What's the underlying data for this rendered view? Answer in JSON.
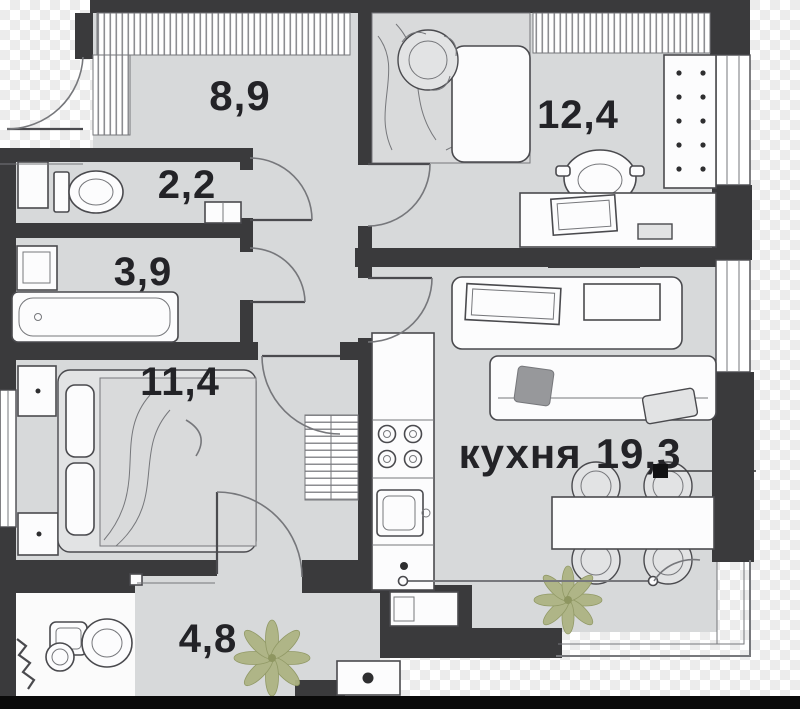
{
  "image": {
    "type": "apartment-floor-plan",
    "background": "transparency-checkerboard",
    "letterbox_bottom": true
  },
  "colors": {
    "wall": "#3a3a3c",
    "floor": "#d7d9da",
    "outline": "#4a4a4e",
    "outline2": "#76777b",
    "plant": "#adb483",
    "plantdk": "#8e9660",
    "letterbox": "#0a0a0a",
    "label_text": "#232327"
  },
  "rooms": {
    "hallway": {
      "area": "8,9",
      "furniture": [
        "wardrobe-hatch"
      ]
    },
    "wc": {
      "area": "2,2",
      "furniture": [
        "toilet",
        "shaft-box",
        "washbasin"
      ]
    },
    "bathroom": {
      "area": "3,9",
      "furniture": [
        "sink-cabinet",
        "bathtub"
      ]
    },
    "bedroom": {
      "area": "11,4",
      "furniture": [
        "double-bed",
        "nightstand",
        "nightstand",
        "wardrobe-hatch",
        "window"
      ]
    },
    "bedroom2": {
      "area": "12,4",
      "furniture": [
        "single-bed",
        "bookcase",
        "desk",
        "office-chair",
        "wardrobe-hatch",
        "window"
      ]
    },
    "kitchen": {
      "name": "кухня",
      "area": "19,3",
      "furniture": [
        "tv-console",
        "sofa",
        "kitchen-counter",
        "stove",
        "sink",
        "dining-table",
        "chairs",
        "plant",
        "window",
        "balcony"
      ]
    },
    "hall_lower": {
      "area": "4,8",
      "furniture": [
        "plant",
        "washing-machine"
      ]
    },
    "bathroom2": {
      "area": "",
      "furniture": [
        "toilet",
        "round-sink",
        "towel-rail"
      ]
    }
  }
}
